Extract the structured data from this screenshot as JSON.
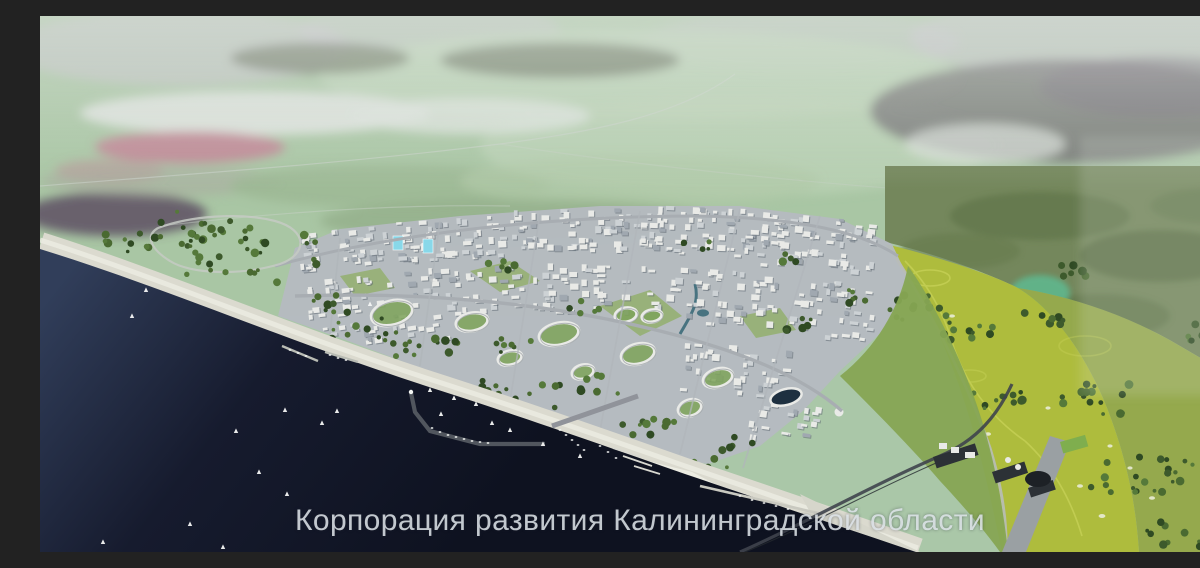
{
  "scene": {
    "description": "Aerial 3D masterplan rendering of a coastal resort city: dark sea with sailboats and a marina at lower left, a white low-rise city in the middle, a bright golf course to the right, hazy farmland horizon above",
    "watermark": {
      "text": "Корпорация развития Калининградской области",
      "color": "rgba(226,231,236,0.85)"
    }
  },
  "palette": {
    "sea_deep": "#0e1220",
    "sea_mid": "#161b2e",
    "sea_light": "#313e5a",
    "beach": "#dbdacf",
    "beach_bright": "#ecece2",
    "city_base": "#b5bbc1",
    "city_light": "#e9eae7",
    "city_mid": "#cdd2d5",
    "city_dark": "#a0a8b0",
    "city_shadow": "#5a636e",
    "road_light": "#c6cac4",
    "road_mid": "#a8adb2",
    "road_dark": "#3f444c",
    "golf_bright": "#aebc3d",
    "golf_dull": "#95a94d",
    "golf_path": "#ccd65c",
    "slope_green": "#86a553",
    "tree": "#3d5a2c",
    "tree_dark": "#2f4a23",
    "tree_mid": "#4a6a31",
    "tree_light": "#55793a",
    "forest_moss": "#74875c",
    "forest_far": "#6e6a6e",
    "field": "#a9c6a4",
    "field_pale": "#bcd3b6",
    "haze": "#dde3dd",
    "lavender": "#c9bfd0",
    "pink_patch": "#c27f93",
    "teal_patch": "#5dbd94",
    "glass_tower": "#88d8e9",
    "canal": "#356676",
    "stadium_roof": "#1e3040",
    "parking": "#2c3136",
    "boat_white": "#f4f6f4"
  }
}
